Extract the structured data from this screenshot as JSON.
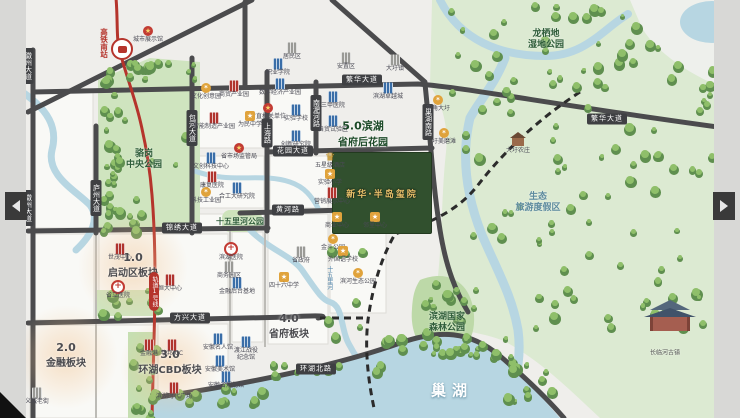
{
  "map_title": "新华·半岛玺院 区位图",
  "carousel": {
    "prev_label": "上一张",
    "next_label": "下一张"
  },
  "colors": {
    "road": "#4b4b4d",
    "metro_red": "#b5342c",
    "water": "#b7d6e2",
    "park_green": "#cfe4bf",
    "plot_green": "#31502e",
    "gold": "#e8c06a"
  },
  "project": {
    "name": "新华·半岛玺院",
    "x": 381,
    "y": 192
  },
  "transit": {
    "station": "高铁南站",
    "line_badge": "轨道1号线"
  },
  "regions": [
    {
      "num": "1.0",
      "name": "启动区板块",
      "x": 133,
      "y": 265,
      "green": false
    },
    {
      "num": "2.0",
      "name": "金融板块",
      "x": 66,
      "y": 355,
      "green": false
    },
    {
      "num": "3.0",
      "name": "环湖CBD板块",
      "x": 170,
      "y": 362,
      "green": false
    },
    {
      "num": "4.0",
      "name": "省府板块",
      "x": 289,
      "y": 326,
      "green": false
    },
    {
      "num": "5.0滨湖",
      "name": "省府后花园",
      "x": 363,
      "y": 133,
      "green": true
    }
  ],
  "areas": [
    {
      "name": "骆岗\n中央公园",
      "x": 144,
      "y": 160,
      "kind": "big"
    },
    {
      "name": "龙栖地\n湿地公园",
      "x": 546,
      "y": 40,
      "kind": "big"
    },
    {
      "name": "滨湖国家\n森林公园",
      "x": 447,
      "y": 323,
      "kind": "big"
    },
    {
      "name": "生态\n旅游度假区",
      "x": 538,
      "y": 203,
      "kind": "resort"
    },
    {
      "name": "十五里河公园",
      "x": 240,
      "y": 222,
      "kind": "small"
    },
    {
      "name": "长临河古镇",
      "x": 665,
      "y": 353,
      "kind": "town"
    },
    {
      "name": "十五里河",
      "x": 329,
      "y": 278,
      "kind": "river-v"
    },
    {
      "name": "巢湖",
      "x": 452,
      "y": 391,
      "kind": "lake"
    }
  ],
  "road_labels": [
    {
      "name": "繁华大道",
      "x": 362,
      "y": 80,
      "v": false
    },
    {
      "name": "繁华大道",
      "x": 607,
      "y": 119,
      "v": false
    },
    {
      "name": "花园大道",
      "x": 293,
      "y": 151,
      "v": false
    },
    {
      "name": "黄河路",
      "x": 288,
      "y": 210,
      "v": false
    },
    {
      "name": "锦绣大道",
      "x": 182,
      "y": 228,
      "v": false
    },
    {
      "name": "方兴大道",
      "x": 190,
      "y": 318,
      "v": false
    },
    {
      "name": "环湖北路",
      "x": 316,
      "y": 369,
      "v": false
    },
    {
      "name": "徽州大道",
      "x": 28,
      "y": 66,
      "v": true
    },
    {
      "name": "徽州大道",
      "x": 28,
      "y": 208,
      "v": true
    },
    {
      "name": "庐州大道",
      "x": 96,
      "y": 198,
      "v": true
    },
    {
      "name": "包河大道",
      "x": 192,
      "y": 128,
      "v": true
    },
    {
      "name": "上海路",
      "x": 267,
      "y": 133,
      "v": true
    },
    {
      "name": "南淝河路",
      "x": 316,
      "y": 113,
      "v": true
    },
    {
      "name": "巢湖南路",
      "x": 428,
      "y": 122,
      "v": true
    }
  ],
  "pois": [
    {
      "type": "gov",
      "x": 148,
      "y": 31,
      "name": "城市展示馆"
    },
    {
      "type": "gray",
      "x": 292,
      "y": 48,
      "name": "居民区"
    },
    {
      "type": "gray",
      "x": 346,
      "y": 58,
      "name": "安置区"
    },
    {
      "type": "gray",
      "x": 395,
      "y": 60,
      "name": "大圩镇"
    },
    {
      "type": "blue",
      "x": 278,
      "y": 64,
      "name": "职业学院"
    },
    {
      "type": "gear",
      "x": 206,
      "y": 88,
      "name": "文化创意园"
    },
    {
      "type": "red",
      "x": 234,
      "y": 86,
      "name": "商贸产业园"
    },
    {
      "type": "blue",
      "x": 280,
      "y": 84,
      "name": "数字经济产业园"
    },
    {
      "type": "blue",
      "x": 388,
      "y": 88,
      "name": "滨湖卓越城"
    },
    {
      "type": "gear",
      "x": 438,
      "y": 100,
      "name": "牛角大圩"
    },
    {
      "type": "blue",
      "x": 333,
      "y": 97,
      "name": "三甲医院"
    },
    {
      "type": "gov",
      "x": 268,
      "y": 108,
      "name": "省直机关单位"
    },
    {
      "type": "blue",
      "x": 296,
      "y": 110,
      "name": "实验学校"
    },
    {
      "type": "red",
      "x": 214,
      "y": 118,
      "name": "智能制造产业园"
    },
    {
      "type": "school",
      "x": 250,
      "y": 116,
      "name": "为民中学"
    },
    {
      "type": "blue",
      "x": 333,
      "y": 121,
      "name": "自贸试验区"
    },
    {
      "type": "gear",
      "x": 444,
      "y": 133,
      "name": "圩美磨滩"
    },
    {
      "type": "blue",
      "x": 296,
      "y": 136,
      "name": "创新研究院"
    },
    {
      "type": "house",
      "x": 518,
      "y": 142,
      "name": "大圩农庄"
    },
    {
      "type": "gov",
      "x": 239,
      "y": 148,
      "name": "省市场监管局"
    },
    {
      "type": "crown",
      "x": 330,
      "y": 157,
      "name": "五星级酒店"
    },
    {
      "type": "blue",
      "x": 211,
      "y": 158,
      "name": "文创科技中心"
    },
    {
      "type": "school",
      "x": 330,
      "y": 174,
      "name": "实验小学"
    },
    {
      "type": "red",
      "x": 212,
      "y": 177,
      "name": "康复医院"
    },
    {
      "type": "gear",
      "x": 206,
      "y": 192,
      "name": "科技工业园"
    },
    {
      "type": "blue",
      "x": 237,
      "y": 188,
      "name": "合工大研究院"
    },
    {
      "type": "red",
      "x": 332,
      "y": 193,
      "name": "营销展示中心"
    },
    {
      "type": "school",
      "x": 337,
      "y": 217,
      "name": "商业中心"
    },
    {
      "type": "school",
      "x": 375,
      "y": 217,
      "name": "邻里中心"
    },
    {
      "type": "gear",
      "x": 333,
      "y": 239,
      "name": "金斗公园"
    },
    {
      "type": "hosp",
      "x": 231,
      "y": 249,
      "name": "滨湖医院"
    },
    {
      "type": "red",
      "x": 120,
      "y": 249,
      "name": "世茂中心"
    },
    {
      "type": "gray",
      "x": 301,
      "y": 252,
      "name": "省政府"
    },
    {
      "type": "school",
      "x": 343,
      "y": 251,
      "name": "外国语学校"
    },
    {
      "type": "gray",
      "x": 229,
      "y": 267,
      "name": "商务园区"
    },
    {
      "type": "gear",
      "x": 358,
      "y": 273,
      "name": "滨河生态公园"
    },
    {
      "type": "school",
      "x": 284,
      "y": 277,
      "name": "四十六中学"
    },
    {
      "type": "red",
      "x": 170,
      "y": 280,
      "name": "恒大中心"
    },
    {
      "type": "blue",
      "x": 237,
      "y": 283,
      "name": "金融后台基地"
    },
    {
      "type": "hosp",
      "x": 118,
      "y": 287,
      "name": "省立医院"
    },
    {
      "type": "blue",
      "x": 218,
      "y": 339,
      "name": "安徽名人馆"
    },
    {
      "type": "blue",
      "x": 246,
      "y": 342,
      "name": "渡江战役\n纪念馆"
    },
    {
      "type": "red",
      "x": 149,
      "y": 345,
      "name": "金融港"
    },
    {
      "type": "red",
      "x": 172,
      "y": 345,
      "name": "华邦ICC"
    },
    {
      "type": "blue",
      "x": 220,
      "y": 361,
      "name": "安徽美术馆"
    },
    {
      "type": "blue",
      "x": 226,
      "y": 377,
      "name": "安徽省规划馆"
    },
    {
      "type": "red",
      "x": 174,
      "y": 388,
      "name": "滨湖时代广场"
    },
    {
      "type": "gray",
      "x": 37,
      "y": 393,
      "name": "义城老街"
    }
  ]
}
